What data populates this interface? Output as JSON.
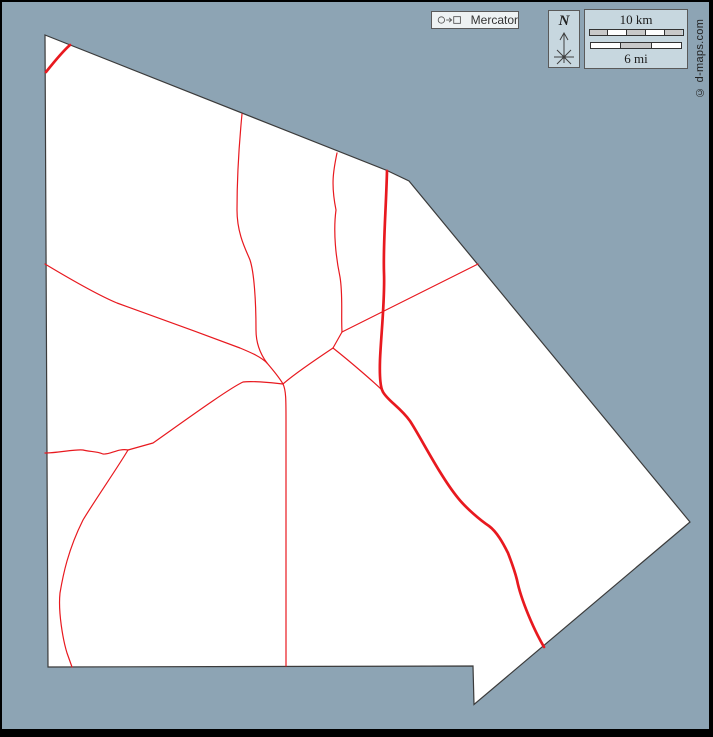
{
  "canvas": {
    "width": 713,
    "height": 737,
    "background_color": "#8da4b4",
    "frame_color": "#000000"
  },
  "map": {
    "land_color": "#ffffff",
    "outline_color": "#3b3b3b",
    "road_color": "#e8191f",
    "outline_points": "45,35 387,170.5 409,181 690,522 474,704.5 473,666 48,667",
    "major_roads": [
      "M70,45 C63,51 54,62 46,72",
      "M387,171 C386,210 383,245 384,273 C385,300 381,335 380,360 C379.5,375 380,387 383,392 C388,401 400,407 410,421 C420,436 440,476 458,498 C466,508 480,520 489,526 C497,532 503,543 508,553 C513,566 515,572 517,580 C521,600 534,630 544,647"
    ],
    "minor_roads": [
      "M242,114 C239,145 237,175 237,210 C237,235 247,252 250,260 C254,272 256,300 256,330 C256,345 261,355 267,363",
      "M337,153 C333,172 331,185 336,210 C333,232 336,258 340,277 C343,295 341,315 342,332",
      "M478,264 L342,332",
      "M45,264 C85,288 105,298 117,303 C145,313 200,333 240,348 C252,353 261,357 267,363",
      "M267,363 C273,370 279,377 283,384",
      "M283,384 C292,376 318,358 333,348",
      "M333,348 L342,332",
      "M333,348 C352,363 376,384 383,391",
      "M283,384 C286,390 286,400 286,420 L286,666",
      "M283,384 C268,382 250,381 243,382 C228,389 180,424 153,443 L128,450",
      "M128,450 C118,448 110,455 103,454 C96,451 90,452 83,450 C75,449 58,453 45,453",
      "M128,450 C118,467 95,500 83,520 C68,550 63,575 60,593 C58,612 63,640 67,653 L72,667"
    ]
  },
  "projection_badge": {
    "label": "Mercator"
  },
  "compass": {
    "north_label": "N"
  },
  "scale_bar": {
    "km_label": "10 km",
    "mi_label": "6 mi",
    "km_segment_colors": [
      "#c9c9c9",
      "#ffffff",
      "#c9c9c9",
      "#ffffff",
      "#c9c9c9"
    ],
    "mi_segment_colors": [
      "#ffffff",
      "#c9c9c9",
      "#ffffff"
    ]
  },
  "credit": {
    "text": "© d-maps.com"
  }
}
